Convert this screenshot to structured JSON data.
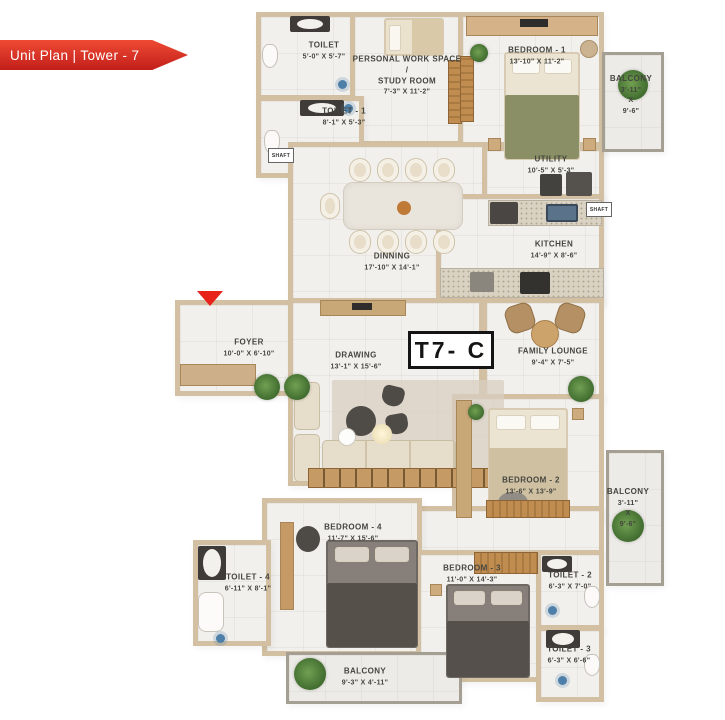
{
  "banner": {
    "label": "Unit Plan | Tower - 7"
  },
  "unit": {
    "label": "T7- C"
  },
  "shafts": {
    "left": "SHAFT",
    "right": "SHAFT"
  },
  "rooms": {
    "toilet_top": {
      "name": "TOILET",
      "dims": "5'-0\" X 5'-7\""
    },
    "study": {
      "line1": "PERSONAL WORK SPACE",
      "line2": "/",
      "line3": "STUDY ROOM",
      "dims": "7'-3\" X 11'-2\""
    },
    "bedroom1": {
      "name": "BEDROOM - 1",
      "dims": "13'-10\" X 11'-2\""
    },
    "balcony_top": {
      "name": "BALCONY",
      "d1": "3'-11\"",
      "d2": "X",
      "d3": "9'-6\""
    },
    "toilet1": {
      "name": "TOILET - 1",
      "dims": "8'-1\" X 5'-3\""
    },
    "utility": {
      "name": "UTILITY",
      "dims": "10'-5\" X 5'-3\""
    },
    "kitchen": {
      "name": "KITCHEN",
      "dims": "14'-9\" X 8'-6\""
    },
    "dining": {
      "name": "DINNING",
      "dims": "17'-10\" X 14'-1\""
    },
    "foyer": {
      "name": "FOYER",
      "dims": "10'-0\" X 6'-10\""
    },
    "drawing": {
      "name": "DRAWING",
      "dims": "13'-1\" X 15'-6\""
    },
    "family_lounge": {
      "name": "FAMILY LOUNGE",
      "dims": "9'-4\" X 7'-5\""
    },
    "bedroom2": {
      "name": "BEDROOM - 2",
      "dims": "13'-6\" X 13'-9\""
    },
    "balcony_right": {
      "name": "BALCONY",
      "d1": "3'-11\"",
      "d2": "X",
      "d3": "9'-6\""
    },
    "bedroom4": {
      "name": "BEDROOM - 4",
      "dims": "11'-7\" X 15'-6\""
    },
    "toilet4": {
      "name": "TOILET - 4",
      "dims": "6'-11\" X 8'-1\""
    },
    "bedroom3": {
      "name": "BEDROOM - 3",
      "dims": "11'-0\" X 14'-3\""
    },
    "toilet2": {
      "name": "TOILET - 2",
      "dims": "6'-3\" X 7'-0\""
    },
    "toilet3": {
      "name": "TOILET - 3",
      "dims": "6'-3\" X 6'-6\""
    },
    "balcony_bottom": {
      "name": "BALCONY",
      "dims": "9'-3\" X 4'-11\""
    }
  },
  "colors": {
    "banner_red": "#d6281e",
    "wall_tan": "#d3c0a2",
    "floor": "#f2f0ed",
    "balcony_floor": "#edebe7",
    "wood": "#c69a64",
    "olive_bed": "#8b8f66",
    "dark_furniture": "#4c4744",
    "plant_green": "#4e7b3a",
    "plumbing_blue": "#4d7fa8",
    "label_gray": "#45453f",
    "unit_box_border": "#141414"
  }
}
